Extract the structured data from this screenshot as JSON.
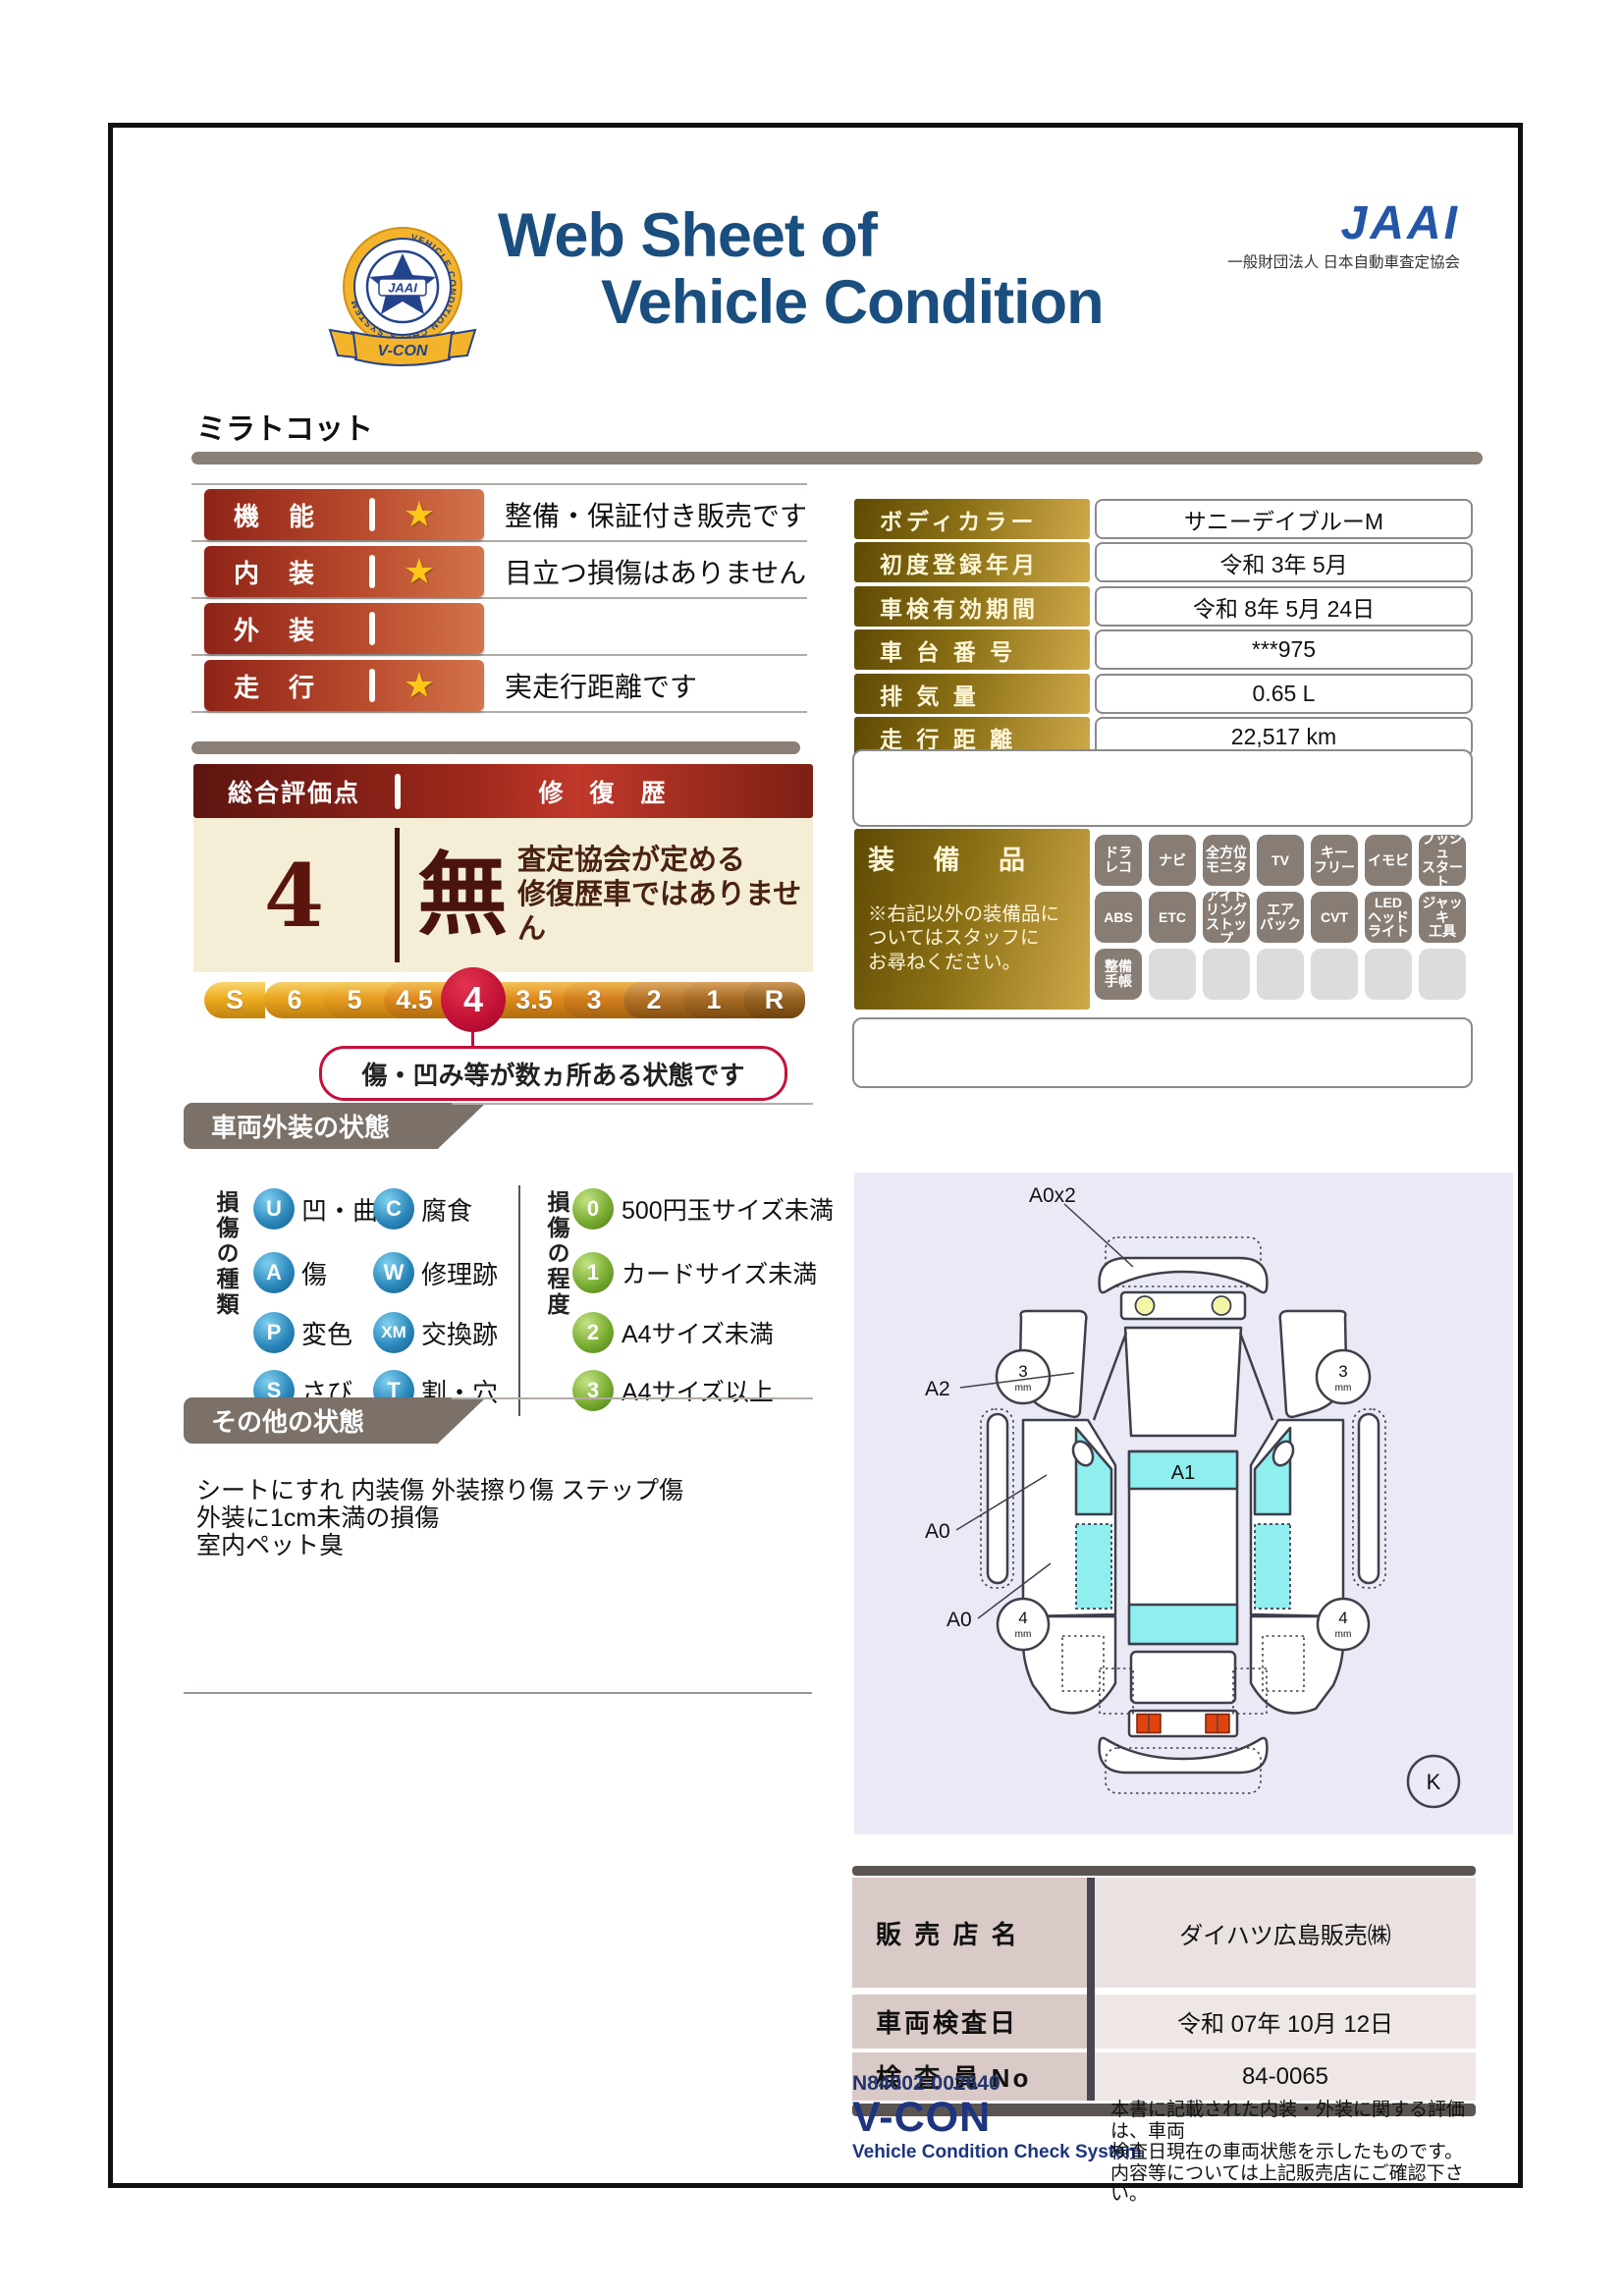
{
  "header": {
    "title_line1": "Web Sheet of",
    "title_line2": "Vehicle Condition",
    "jaai_word": "JAAI",
    "jaai_org": "一般財団法人 日本自動車査定協会",
    "badge": {
      "ring_text": "VEHICLE CONDITION CHECK SYSTEM",
      "center_text": "JAAI",
      "banner_text": "V-CON"
    }
  },
  "model_name": "ミラトコット",
  "ratings": [
    {
      "label": "機　能",
      "star": "★",
      "description": "整備・保証付き販売です"
    },
    {
      "label": "内　装",
      "star": "★",
      "description": "目立つ損傷はありません"
    },
    {
      "label": "外　装",
      "star": "",
      "description": ""
    },
    {
      "label": "走　行",
      "star": "★",
      "description": "実走行距離です"
    }
  ],
  "vehicle_info": [
    {
      "label": "ボディカラー",
      "value": "サニーデイブルーM"
    },
    {
      "label": "初度登録年月",
      "value": "令和 3年 5月"
    },
    {
      "label": "車検有効期間",
      "value": "令和 8年 5月 24日"
    },
    {
      "label": "車 台 番 号",
      "value": "***975"
    },
    {
      "label": "排 気 量",
      "value": "0.65 L"
    },
    {
      "label": "走 行 距 離",
      "value": "22,517 km"
    }
  ],
  "overall": {
    "header_left": "総合評価点",
    "header_right": "修 復 歴",
    "score": "4",
    "repair_char": "無",
    "repair_desc": "査定協会が定める\n修復歴車ではありません",
    "scale": [
      "S",
      "6",
      "5",
      "4.5",
      "4",
      "3.5",
      "3",
      "2",
      "1",
      "R"
    ],
    "selected": "4",
    "scale_colors": [
      "#eead21",
      "#eaa520",
      "#e79d1f",
      "#e08a1d",
      "#e28d1e",
      "#e08a1d",
      "#d47f1f",
      "#b57428",
      "#a86d26",
      "#986524"
    ],
    "selected_color": "#c00f34",
    "callout": "傷・凹み等が数ヵ所ある状態です"
  },
  "equipment": {
    "title": "装 備 品",
    "note": "※右記以外の装備品に\nついてはスタッフに\nお尋ねください。",
    "row1": [
      "ドラ\nレコ",
      "ナビ",
      "全方位\nモニタ",
      "TV",
      "キー\nフリー",
      "イモビ",
      "プッシュ\nスタート"
    ],
    "row2": [
      "ABS",
      "ETC",
      "アイド\nリング\nストップ",
      "エア\nバック",
      "CVT",
      "LED\nヘッド\nライト",
      "ジャッキ\n工具"
    ],
    "row3": [
      "整備\n手帳"
    ]
  },
  "exterior_section": {
    "title": "車両外装の状態",
    "type_label": "損傷の種類",
    "types": [
      {
        "code": "U",
        "label": "凹・曲"
      },
      {
        "code": "C",
        "label": "腐食"
      },
      {
        "code": "A",
        "label": "傷"
      },
      {
        "code": "W",
        "label": "修理跡"
      },
      {
        "code": "P",
        "label": "変色"
      },
      {
        "code": "XM",
        "label": "交換跡"
      },
      {
        "code": "S",
        "label": "さび"
      },
      {
        "code": "T",
        "label": "割・穴"
      }
    ],
    "degree_label": "損傷の程度",
    "degrees": [
      {
        "code": "0",
        "label": "500円玉サイズ未満"
      },
      {
        "code": "1",
        "label": "カードサイズ未満"
      },
      {
        "code": "2",
        "label": "A4サイズ未満"
      },
      {
        "code": "3",
        "label": "A4サイズ以上"
      }
    ]
  },
  "other_section": {
    "title": "その他の状態",
    "notes": "シートにすれ 内装傷 外装擦り傷 ステップ傷\n外装に1cm未満の損傷\n室内ペット臭"
  },
  "diagram": {
    "front_label": "A0x2",
    "fender_label": "A2",
    "door_label": "A0",
    "rear_door_label": "A0",
    "roof_label": "A1",
    "key_label": "K",
    "tire_front": "3",
    "tire_rear": "4",
    "tire_unit": "mm",
    "window_color": "#8feeee"
  },
  "dealer": [
    {
      "label": "販 売 店 名",
      "value": "ダイハツ広島販売㈱"
    },
    {
      "label": "車両検査日",
      "value": "令和 07年 10月 12日"
    },
    {
      "label": "検 査 員 No",
      "value": "84-0065"
    }
  ],
  "footer": {
    "serial": "N84002-002640",
    "vcon": "V-CON",
    "vcon_sub": "Vehicle Condition Check System",
    "disclaimer": "本書に記載された内装・外装に関する評価は、車両\n検査日現在の車両状態を示したものです。\n内容等については上記販売店にご確認下さい。"
  },
  "colors": {
    "title_navy": "#1a4e7e",
    "jaai_blue": "#2456a8",
    "rating_red": "#9c2a1b",
    "gold": "#8a6f14",
    "overall_header_red": "#9e281b",
    "cream": "#f4eed6",
    "crimson": "#c5113a",
    "tab_gray": "#7b7168",
    "sphere_blue": "#2a86ba",
    "sphere_green": "#76aa2e",
    "lavender": "#e9eaf6"
  }
}
